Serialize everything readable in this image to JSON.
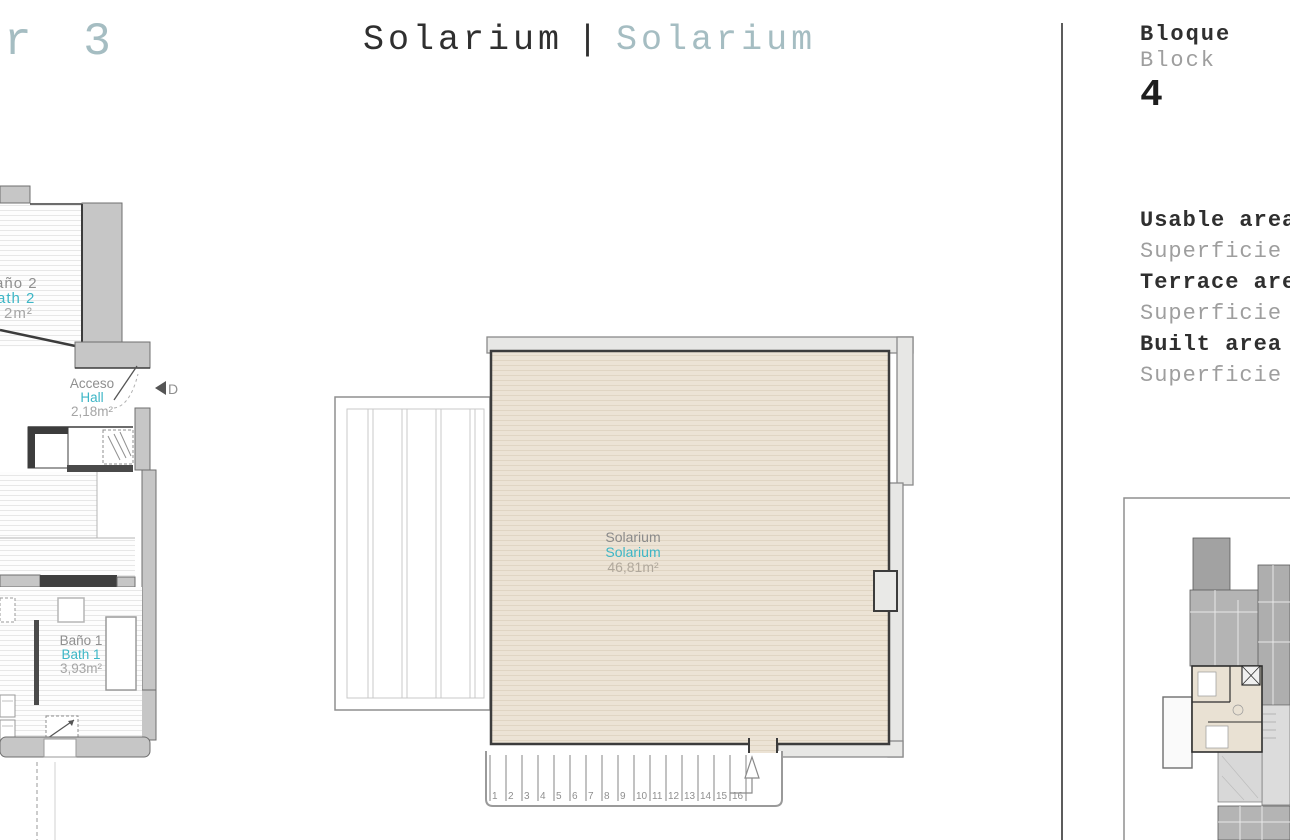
{
  "header": {
    "floor_label_partial": "r 3",
    "title_es": "Solarium",
    "title_separator": "|",
    "title_en": "Solarium"
  },
  "block_panel": {
    "label_es": "Bloque",
    "label_en": "Block",
    "number": "4"
  },
  "areas_panel": {
    "rows": [
      {
        "en": "Usable area",
        "es": "Superficie"
      },
      {
        "en": "Terrace area",
        "es": "Superficie"
      },
      {
        "en": "Built area",
        "es": "Superficie"
      }
    ]
  },
  "left_plan": {
    "bath2": {
      "name_es": "Baño 2",
      "name_en": "Bath 2",
      "area": "2m²"
    },
    "hall": {
      "name_es": "Acceso",
      "name_en": "Hall",
      "area": "2,18m²"
    },
    "bath1": {
      "name_es": "Baño 1",
      "name_en": "Bath 1",
      "area": "3,93m²"
    },
    "door_marker": "D"
  },
  "solarium_plan": {
    "room": {
      "name_es": "Solarium",
      "name_en": "Solarium",
      "area": "46,81m²"
    },
    "stair_numbers": [
      "1",
      "2",
      "3",
      "4",
      "5",
      "6",
      "7",
      "8",
      "9",
      "10",
      "11",
      "12",
      "13",
      "14",
      "15",
      "16"
    ]
  },
  "colors": {
    "accent_teal": "#3db6c6",
    "pale_title": "#a5bdc2",
    "dark_text": "#2f2f2f",
    "gray_text": "#8f8f8f",
    "wall_gray": "#c6c6c6",
    "parapet_gray": "#e7e7e5",
    "floor_beige": "#ece3d5"
  }
}
